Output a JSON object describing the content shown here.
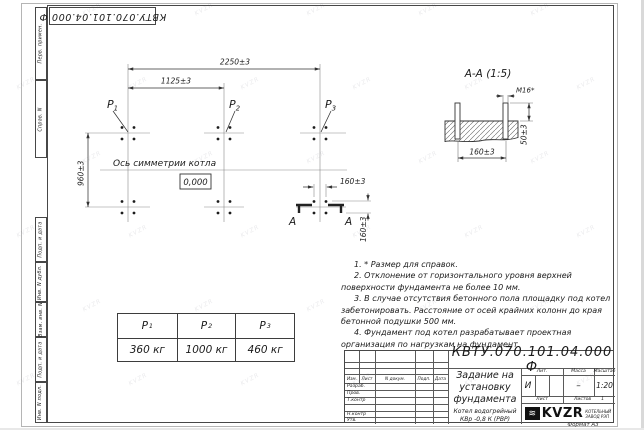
{
  "sheet": {
    "doc_number_stamp": "КВТУ.070.101.04.000  Ф",
    "format_note": "Формат А3",
    "watermark": "KVZR"
  },
  "margin_fields": {
    "top": [
      {
        "label": "Перв. примен."
      },
      {
        "label": "Справ. N"
      }
    ],
    "bottom": [
      {
        "label": "Подп. и дата"
      },
      {
        "label": "Инв. N дубл."
      },
      {
        "label": "Взам. инв. N"
      },
      {
        "label": "Подп. и дата"
      },
      {
        "label": "Инв. N подл."
      }
    ]
  },
  "plan": {
    "dim_2250": "2250±3",
    "dim_1125": "1125±3",
    "dim_960": "960±3",
    "dim_160_h": "160±3",
    "dim_160_v": "160±3",
    "axis_label": "Ось симметрии котла",
    "level_mark": "0,000",
    "point_letter": "Р",
    "point_subs": [
      "1",
      "2",
      "3"
    ],
    "section_letter_left": "А",
    "section_letter_right": "А"
  },
  "section_view": {
    "title": "А-А (1:5)",
    "bolt_callout": "М16*",
    "dim_protrusion": "50±3",
    "dim_spacing": "160±3"
  },
  "notes": {
    "items": [
      "1.  * Размер для справок.",
      "2.  Отклонение от горизонтального уровня верхней поверхности фундамента не более 10 мм.",
      "3.  В случае отсутствия бетонного пола площадку под котел забетонировать. Расстояние от осей крайних колонн до края бетонной подушки 500 мм.",
      "4.  Фундамент под котел разрабатывает проектная организация по нагрузкам на фундамент."
    ]
  },
  "load_table": {
    "header_letter": "Р",
    "header_subs": [
      "1",
      "2",
      "3"
    ],
    "values": [
      "360 кг",
      "1000 кг",
      "460 кг"
    ]
  },
  "title_block": {
    "doc_number": "КВТУ.070.101.04.000  Ф",
    "title_lines": [
      "Задание на",
      "установку",
      "фундамента"
    ],
    "product_lines": [
      "Котел водогрейный",
      "КВр -0,8 К (РВР)"
    ],
    "col_headers": {
      "izm": "Изм.",
      "list": "Лист",
      "doc": "N докум.",
      "podp": "Подп.",
      "date": "Дата"
    },
    "sign_rows": [
      "Разраб.",
      "Пров.",
      "Т.контр",
      "",
      "Н.контр",
      "Утв."
    ],
    "lit_header": "Лит.",
    "mass_header": "Масса",
    "scale_header": "Масштаб",
    "lit_value": "И",
    "mass_value": "–",
    "scale_value": "1:20",
    "sheet_label": "Лист",
    "sheets_label": "Листов",
    "sheets_value": "1",
    "brand": "KVZR",
    "brand_mark": "≋",
    "brand_sub1": "КОТЕЛЬНЫЙ",
    "brand_sub2": "ЗАВОД РЭП"
  }
}
